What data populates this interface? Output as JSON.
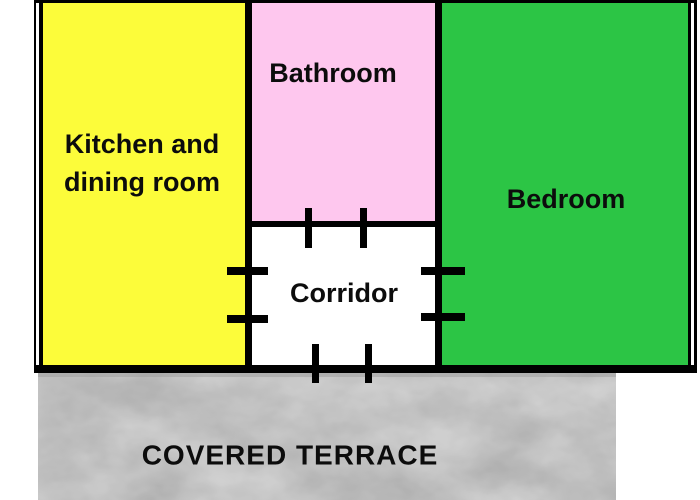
{
  "floorplan": {
    "type": "apartment floor plan",
    "wall_color": "#000000",
    "rooms": {
      "kitchen": {
        "label_line1": "Kitchen and",
        "label_line2": "dining room",
        "color": "#fcfc3a"
      },
      "bathroom": {
        "label": "Bathroom",
        "color": "#fec7ee"
      },
      "corridor": {
        "label": "Corridor",
        "color": "#ffffff"
      },
      "bedroom": {
        "label": "Bedroom",
        "color": "#2cc545"
      },
      "terrace": {
        "label": "COVERED TERRACE",
        "color": "#dcdcdc"
      }
    }
  }
}
